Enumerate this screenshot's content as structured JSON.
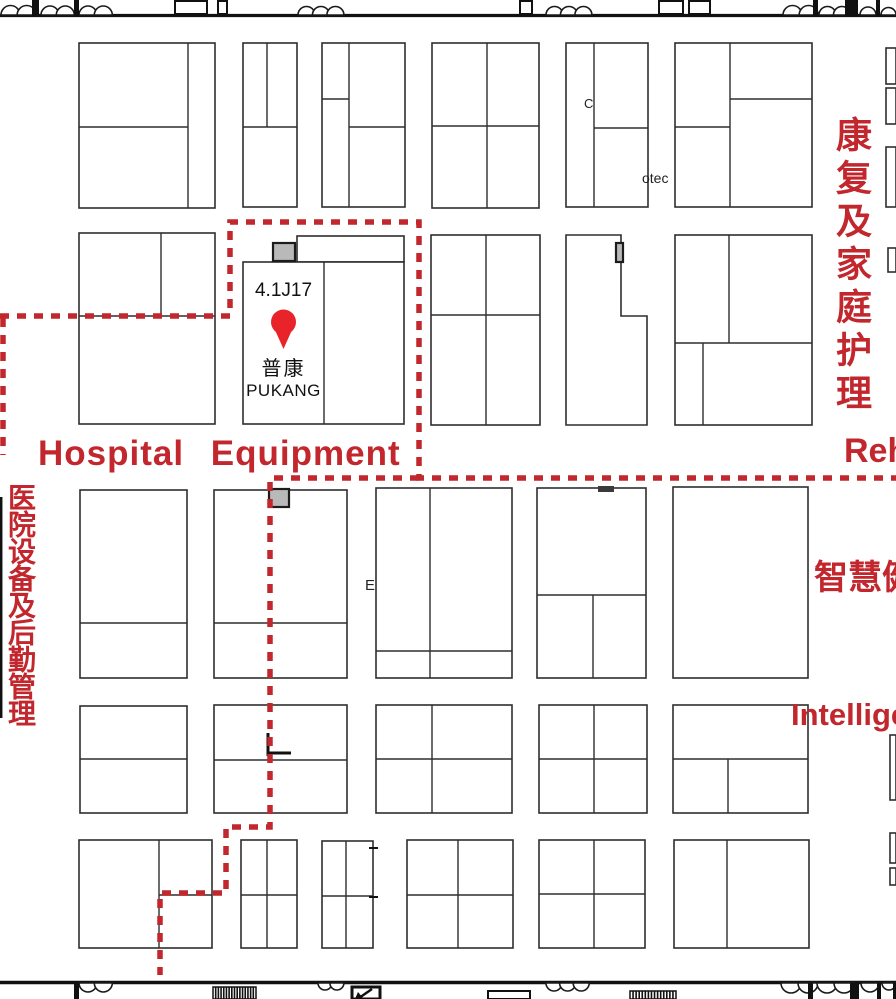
{
  "map": {
    "accent_color": "#c1272d",
    "pin_color": "#e8232a",
    "labels": {
      "zone_hospital_equipment_en": "Hospital Equipment",
      "zone_rehab_en_partial": "Reh",
      "zone_rehab_cn": "康复及家庭护理",
      "zone_hospital_logistics_cn": "医院设备及后勤管理",
      "zone_smart_health_cn_partial": "智慧健",
      "zone_intelligent_en_partial": "Intellige",
      "booth_text_otec": "otec",
      "stray_letter_e": "E",
      "stray_letter_c": "C"
    },
    "highlight_booth": {
      "number": "4.1J17",
      "name_cn": "普康",
      "name_en": "PUKANG"
    }
  },
  "floorplan": {
    "booths": [
      [
        79,
        43,
        136,
        165
      ],
      [
        243,
        43,
        54,
        164
      ],
      [
        322,
        43,
        83,
        164
      ],
      [
        432,
        43,
        107,
        165
      ],
      [
        566,
        43,
        82,
        164
      ],
      [
        675,
        43,
        137,
        164
      ],
      [
        886,
        48,
        10,
        36
      ],
      [
        886,
        88,
        10,
        36
      ],
      [
        886,
        147,
        10,
        60
      ],
      [
        79,
        233,
        136,
        191
      ],
      [
        297,
        236,
        107,
        26
      ],
      [
        243,
        262,
        161,
        162
      ],
      [
        431,
        235,
        109,
        190
      ],
      [
        675,
        235,
        137,
        190
      ],
      [
        888,
        248,
        8,
        24
      ],
      [
        80,
        490,
        107,
        188
      ],
      [
        214,
        490,
        133,
        188
      ],
      [
        376,
        488,
        136,
        190
      ],
      [
        537,
        488,
        109,
        190
      ],
      [
        673,
        487,
        135,
        191
      ],
      [
        80,
        706,
        107,
        107
      ],
      [
        214,
        705,
        133,
        108
      ],
      [
        376,
        705,
        136,
        108
      ],
      [
        539,
        705,
        108,
        108
      ],
      [
        673,
        705,
        135,
        108
      ],
      [
        890,
        735,
        6,
        65
      ],
      [
        79,
        840,
        133,
        108
      ],
      [
        241,
        840,
        56,
        108
      ],
      [
        322,
        841,
        51,
        107
      ],
      [
        407,
        840,
        106,
        108
      ],
      [
        539,
        840,
        106,
        108
      ],
      [
        674,
        840,
        135,
        108
      ],
      [
        890,
        833,
        6,
        30
      ],
      [
        890,
        868,
        6,
        17
      ]
    ],
    "l_booth_points": "566,235 621,235 621,316 647,316 647,425 566,425",
    "dividers": [
      [
        188,
        43,
        188,
        208
      ],
      [
        79,
        127,
        188,
        127
      ],
      [
        267,
        43,
        267,
        127
      ],
      [
        243,
        127,
        297,
        127
      ],
      [
        349,
        43,
        349,
        207
      ],
      [
        322,
        99,
        349,
        99
      ],
      [
        349,
        127,
        405,
        127
      ],
      [
        487,
        43,
        487,
        208
      ],
      [
        432,
        126,
        539,
        126
      ],
      [
        594,
        43,
        594,
        207
      ],
      [
        594,
        128,
        648,
        128
      ],
      [
        730,
        43,
        730,
        207
      ],
      [
        730,
        99,
        812,
        99
      ],
      [
        675,
        127,
        730,
        127
      ],
      [
        161,
        233,
        161,
        316
      ],
      [
        79,
        316,
        215,
        316
      ],
      [
        324,
        262,
        324,
        424
      ],
      [
        486,
        235,
        486,
        425
      ],
      [
        431,
        315,
        540,
        315
      ],
      [
        729,
        235,
        729,
        343
      ],
      [
        675,
        343,
        812,
        343
      ],
      [
        703,
        343,
        703,
        425
      ],
      [
        80,
        623,
        187,
        623
      ],
      [
        214,
        623,
        347,
        623
      ],
      [
        430,
        488,
        430,
        678
      ],
      [
        376,
        651,
        512,
        651
      ],
      [
        537,
        595,
        646,
        595
      ],
      [
        593,
        595,
        593,
        678
      ],
      [
        80,
        759,
        187,
        759
      ],
      [
        214,
        760,
        347,
        760
      ],
      [
        432,
        705,
        432,
        813
      ],
      [
        376,
        759,
        512,
        759
      ],
      [
        594,
        705,
        594,
        813
      ],
      [
        539,
        759,
        647,
        759
      ],
      [
        673,
        759,
        808,
        759
      ],
      [
        728,
        759,
        728,
        813
      ],
      [
        159,
        840,
        159,
        948
      ],
      [
        159,
        895,
        212,
        895
      ],
      [
        267,
        840,
        267,
        948
      ],
      [
        241,
        895,
        297,
        895
      ],
      [
        346,
        841,
        346,
        948
      ],
      [
        322,
        896,
        373,
        896
      ],
      [
        458,
        840,
        458,
        948
      ],
      [
        407,
        895,
        513,
        895
      ],
      [
        594,
        840,
        594,
        948
      ],
      [
        539,
        894,
        645,
        894
      ],
      [
        727,
        840,
        727,
        948
      ]
    ],
    "dashed_paths": [
      "M 0 316 H 230 V 222 H 419 V 478 H 896",
      "M 419 478 H 270 V 827 H 226 V 893 H 160 V 975",
      "M 3 318 V 455"
    ],
    "walls": [
      [
        0,
        15.5,
        896,
        15.5,
        3.2
      ],
      [
        0,
        982.5,
        896,
        982.5,
        3.4
      ],
      [
        1.2,
        497,
        1.2,
        718,
        2.5
      ]
    ],
    "door_frames": [
      [
        175,
        1,
        32,
        13
      ],
      [
        218,
        1,
        9,
        13
      ],
      [
        520,
        1,
        12,
        13
      ],
      [
        659,
        1,
        24,
        13
      ],
      [
        689,
        1,
        21,
        13
      ]
    ],
    "posts": [
      [
        32,
        0,
        7,
        16
      ],
      [
        74,
        0,
        5,
        16
      ],
      [
        813,
        0,
        5,
        16
      ],
      [
        845,
        0,
        13,
        16
      ],
      [
        876,
        0,
        4,
        16
      ],
      [
        74,
        983,
        5,
        16
      ],
      [
        808,
        983,
        5,
        16
      ],
      [
        850,
        983,
        9,
        16
      ],
      [
        877,
        983,
        4,
        16
      ],
      [
        893,
        983,
        3,
        16
      ]
    ],
    "scallops": [
      {
        "x": 1,
        "y": 15,
        "r": 9.5,
        "n": 2,
        "dir": "up"
      },
      {
        "x": 41,
        "y": 15,
        "r": 9,
        "n": 2,
        "dir": "up"
      },
      {
        "x": 79,
        "y": 15,
        "r": 9,
        "n": 2,
        "dir": "up"
      },
      {
        "x": 298,
        "y": 15,
        "r": 8.5,
        "n": 3,
        "dir": "up"
      },
      {
        "x": 546,
        "y": 15,
        "r": 8.5,
        "n": 3,
        "dir": "up"
      },
      {
        "x": 783,
        "y": 15,
        "r": 9.5,
        "n": 2,
        "dir": "up"
      },
      {
        "x": 819,
        "y": 15,
        "r": 8.5,
        "n": 2,
        "dir": "up"
      },
      {
        "x": 860,
        "y": 15,
        "r": 8,
        "n": 1,
        "dir": "up"
      },
      {
        "x": 881,
        "y": 15,
        "r": 7.5,
        "n": 1,
        "dir": "up"
      },
      {
        "x": 79,
        "y": 983,
        "r": 9,
        "n": 2,
        "dir": "down"
      },
      {
        "x": 318,
        "y": 983,
        "r": 7,
        "n": 2,
        "dir": "down"
      },
      {
        "x": 546,
        "y": 983,
        "r": 8,
        "n": 3,
        "dir": "down"
      },
      {
        "x": 781,
        "y": 983,
        "r": 10,
        "n": 2,
        "dir": "down"
      },
      {
        "x": 817,
        "y": 983,
        "r": 10,
        "n": 2,
        "dir": "down"
      },
      {
        "x": 861,
        "y": 983,
        "r": 9,
        "n": 1,
        "dir": "down"
      },
      {
        "x": 882,
        "y": 983,
        "r": 7,
        "n": 1,
        "dir": "down"
      }
    ],
    "gray_squares": [
      [
        273,
        243,
        22,
        18
      ],
      [
        616,
        243,
        7,
        19
      ],
      [
        269,
        489,
        20,
        18
      ]
    ],
    "dark_rects": [
      [
        598,
        486,
        16,
        6
      ]
    ],
    "thick_lines": [
      [
        268,
        733,
        268,
        756,
        3
      ],
      [
        268,
        753,
        291,
        753,
        3
      ],
      [
        369,
        848,
        378,
        848,
        2
      ],
      [
        369,
        897,
        378,
        897,
        2
      ]
    ],
    "barcodes": [
      {
        "x": 213,
        "y": 987,
        "w": 43,
        "h": 12,
        "n": 16
      },
      {
        "x": 630,
        "y": 991,
        "w": 46,
        "h": 8,
        "n": 15
      }
    ],
    "outline_rects": [
      [
        488,
        991,
        42,
        8
      ]
    ],
    "arrow_box": {
      "x": 352,
      "y": 987,
      "w": 28,
      "h": 12
    },
    "pin": {
      "cx": 283.5,
      "cy": 322,
      "r": 12.5,
      "tip": 349
    }
  }
}
